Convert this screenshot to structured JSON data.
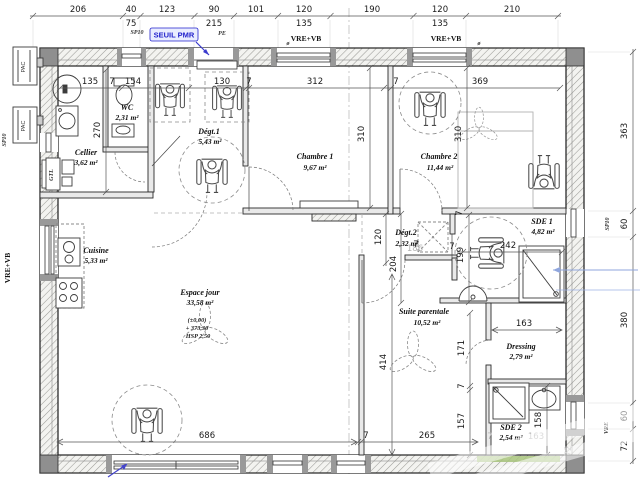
{
  "annotations": {
    "seuil_pmr": "SEUIL PMR",
    "sp10": "SP10",
    "pe": "PE",
    "vre_vb": "VRE+VB",
    "vre": "VRE",
    "gtl": "GTL",
    "pac": "PAC",
    "diam": "ø"
  },
  "rooms": {
    "wc": {
      "name": "WC",
      "area": "2,31 m²"
    },
    "cellier": {
      "name": "Cellier",
      "area": "3,62 m²"
    },
    "cuisine": {
      "name": "Cuisine",
      "area": "5,33 m²"
    },
    "degt1": {
      "name": "Dégt.1",
      "area": "5,43 m²"
    },
    "chambre1": {
      "name": "Chambre 1",
      "area": "9,67 m²"
    },
    "chambre2": {
      "name": "Chambre 2",
      "area": "11,44 m²"
    },
    "espace_jour": {
      "name": "Espace jour",
      "area": "33,58 m²",
      "niveau": "(±0,00)",
      "altitude": "+ 373,30",
      "hauteur": "HSP 2,50"
    },
    "degt2": {
      "name": "Dégt.2",
      "area": "2,32 m²"
    },
    "suite_parentale": {
      "name": "Suite parentale",
      "area": "10,52 m²"
    },
    "sde1": {
      "name": "SDE 1",
      "area": "4,82 m²"
    },
    "dressing": {
      "name": "Dressing",
      "area": "2,79 m²"
    },
    "sde2": {
      "name": "SDE 2",
      "area": "2,54 m²"
    }
  },
  "dims": {
    "top_row1": [
      "206",
      "40",
      "123",
      "90",
      "101",
      "120",
      "190",
      "120",
      "210"
    ],
    "top_row2": [
      "75",
      "215",
      "135",
      "135"
    ],
    "right_chain": [
      "363",
      "60",
      "380",
      "60",
      "72"
    ],
    "bottom_chain": [
      "686",
      "7",
      "265"
    ],
    "interior_horizontal": {
      "cellier_135": "135",
      "wall_7a": "7",
      "wc_154": "154",
      "degt1_130": "130",
      "wall_7b": "7",
      "chambre1_312": "312",
      "wall_7c": "7",
      "chambre2_369": "369",
      "sde1_242": "242",
      "wall_7d": "7",
      "wall_7e": "7",
      "dressing_163": "163"
    },
    "interior_vertical": {
      "cellier_270": "270",
      "chambre1_310": "310",
      "chambre2_310": "310",
      "wall_7f": "7",
      "degt2_120": "120",
      "couloir_204": "204",
      "sde1_199": "199",
      "dressing_171": "171",
      "wall_7g": "7",
      "sde2_157": "157",
      "sde2_158": "158",
      "suite_414": "414"
    },
    "gray": {
      "suite_186": "186",
      "sde2_7": "7",
      "sde2_163": "163",
      "right_72": "72"
    }
  }
}
